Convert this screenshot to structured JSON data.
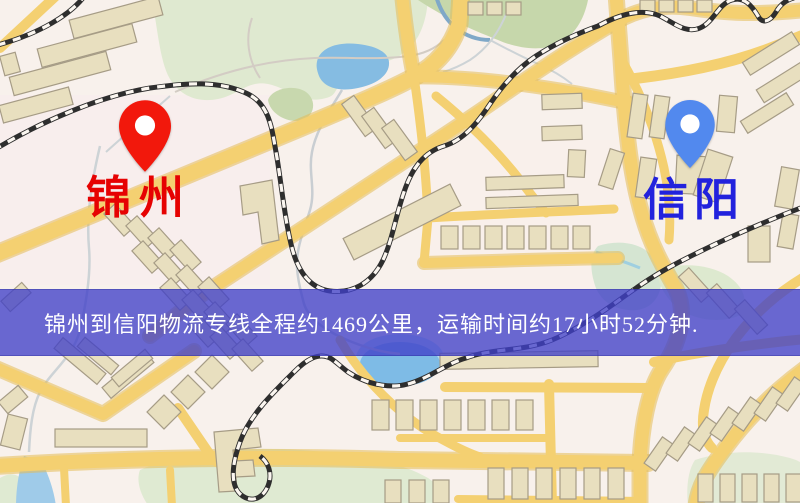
{
  "map": {
    "origin": {
      "name": "锦州",
      "pin_color": "#f2180c",
      "label_color": "#e60202"
    },
    "destination": {
      "name": "信阳",
      "pin_color": "#5289ee",
      "label_color": "#2222dd"
    }
  },
  "banner": {
    "text": "锦州到信阳物流专线全程约1469公里，运输时间约17小时52分钟.",
    "background_color": "#4040c8",
    "text_color": "#ffffff",
    "route": {
      "origin": "锦州",
      "destination": "信阳",
      "distance_text": "约1469公里",
      "distance_km": 1469,
      "duration_text": "约17小时52分钟"
    }
  }
}
